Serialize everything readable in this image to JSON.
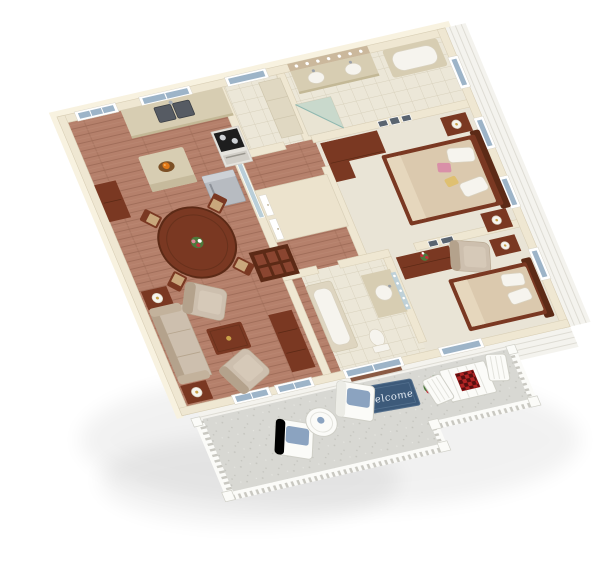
{
  "scene": {
    "type": "3D isometric floor plan rendering",
    "background": "#ffffff",
    "rooms": [
      "kitchen",
      "dining-area",
      "living-room",
      "hallway",
      "laundry-room",
      "master-bathroom",
      "master-bedroom",
      "bathroom-2",
      "bedroom-2",
      "patio"
    ]
  },
  "patio": {
    "welcome_mat_text": "Welcome"
  },
  "palette": {
    "background": "#ffffff",
    "wall": "#efe7d2",
    "wall_edge": "#d9cfb6",
    "roof": "#f8f2e0",
    "wood": "#b5806b",
    "wood_dark": "#9e6b57",
    "tile": "#ece7d8",
    "tile_line": "#d8d1bc",
    "carpet": "#e9e4d6",
    "counter": "#d7cdb2",
    "dark_wood": "#7a3822",
    "dark_wood_deep": "#5c2a16",
    "upholstery": "#cdbfae",
    "upholstery_shade": "#b4a28c",
    "appliance": "#b7bbc1",
    "glass": "#9db4c8",
    "mirror": "#b9ced8",
    "patio_floor": "#d8d8d3",
    "patio_speck": "#c4c4be",
    "railing": "#fbfbf8",
    "railing_shadow": "#c9c8c1",
    "siding": "#f4f3ee",
    "siding_line": "#dedcd4",
    "mat_navy": "#3d5a7a",
    "mat_text": "#e4ebf3",
    "flower_red": "#c4303c",
    "flower_pink": "#e0889a",
    "leaf_green": "#4d7a3c",
    "cushion_blue": "#8ba3c0",
    "checker_red": "#b32424",
    "checker_dark": "#571010",
    "fruit_orange": "#e07818",
    "lamp_gold": "#c9a24a",
    "fixture_white": "#f6f4ee"
  }
}
